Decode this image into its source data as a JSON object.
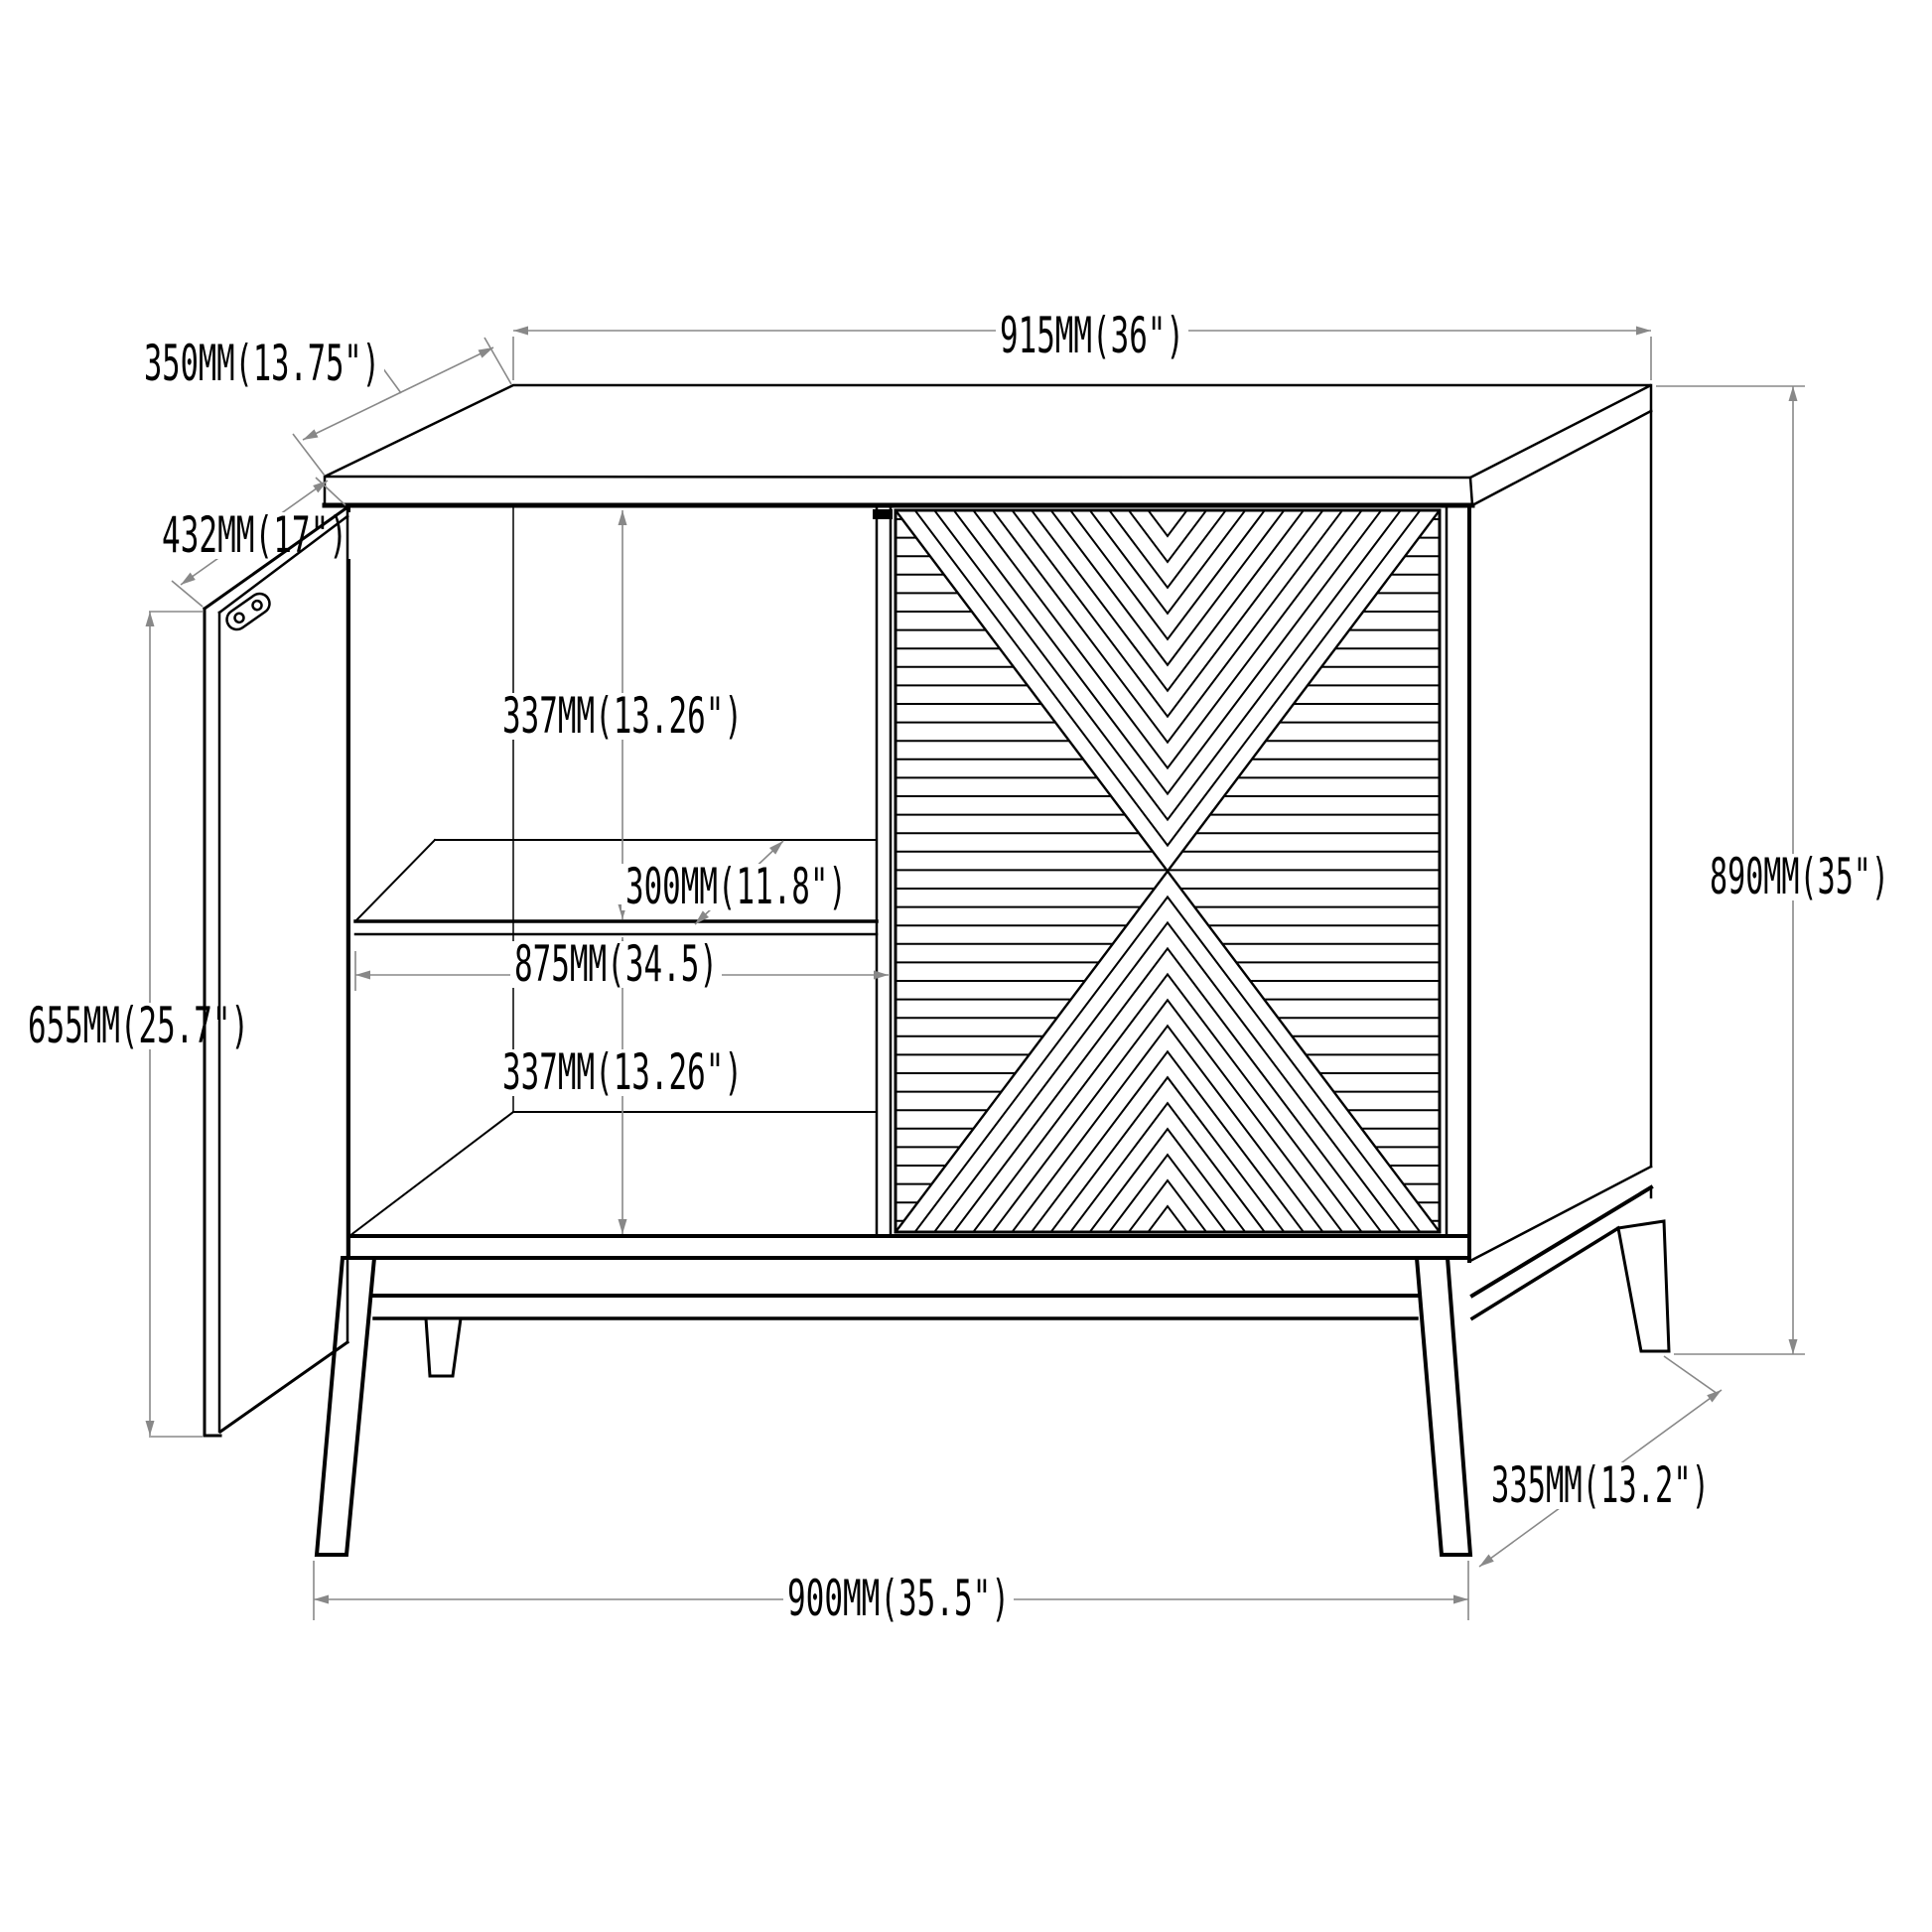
{
  "drawing": {
    "type": "furniture-technical-drawing",
    "subject": "Two-door accent cabinet line drawing: open left door with hinge, interior shelf, chevron-pattern right door, splayed legs",
    "background_color": "#ffffff",
    "line_color": "#000000",
    "dimension_color": "#888888"
  },
  "dimensions": {
    "top_width": "915MM(36\")",
    "top_depth": "350MM(13.75\")",
    "door_open_width": "432MM(17\")",
    "upper_compartment_height": "337MM(13.26\")",
    "shelf_depth": "300MM(11.8\")",
    "interior_width": "875MM(34.5)",
    "door_height": "655MM(25.7\")",
    "lower_compartment_height": "337MM(13.26\")",
    "overall_height": "890MM(35\")",
    "base_depth": "335MM(13.2\")",
    "base_width": "900MM(35.5\")"
  }
}
